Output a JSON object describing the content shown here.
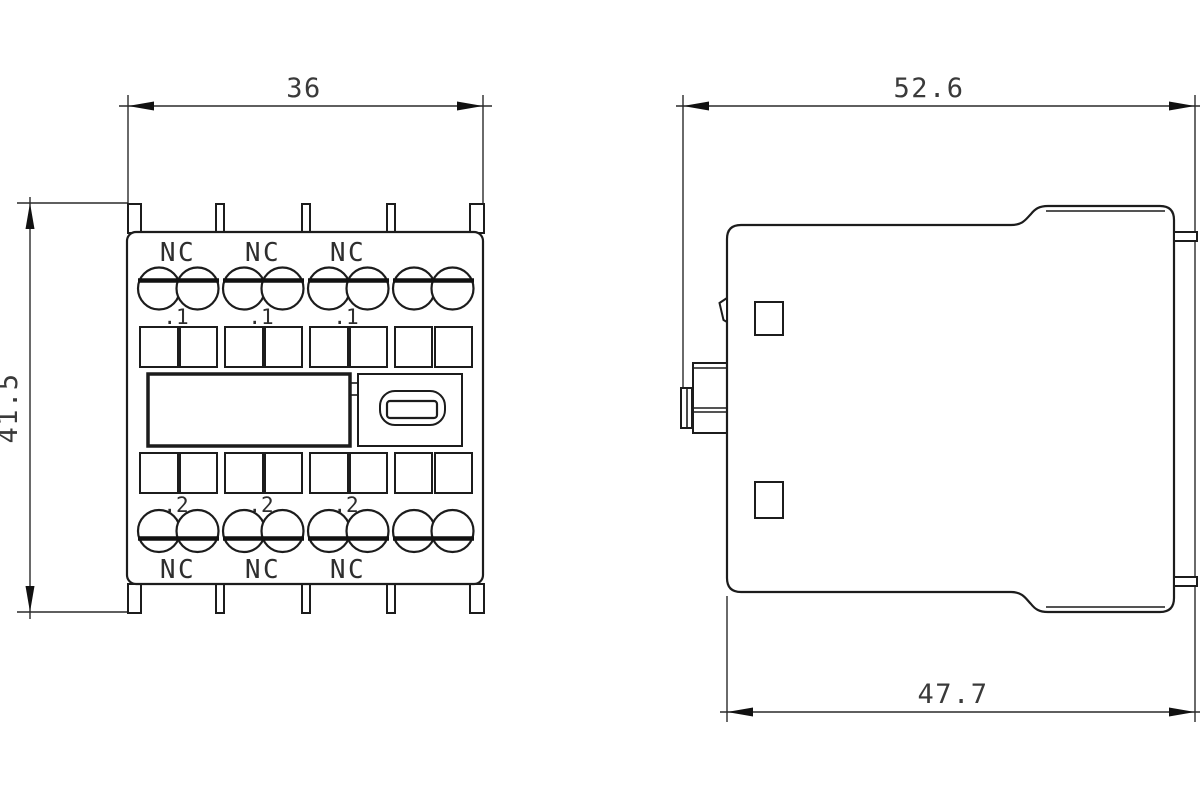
{
  "colors": {
    "line": "#1c1c1c",
    "text": "#3a3a3a",
    "background": "#ffffff"
  },
  "front_view": {
    "width_dim": "36",
    "height_dim": "41.5",
    "nc_top": [
      "NC",
      "NC",
      "NC"
    ],
    "terminals_top": [
      ".1",
      ".1",
      ".1"
    ],
    "terminals_bottom": [
      ".2",
      ".2",
      ".2"
    ],
    "nc_bottom": [
      "NC",
      "NC",
      "NC"
    ]
  },
  "side_view": {
    "top_width_dim": "52.6",
    "bottom_width_dim": "47.7"
  }
}
